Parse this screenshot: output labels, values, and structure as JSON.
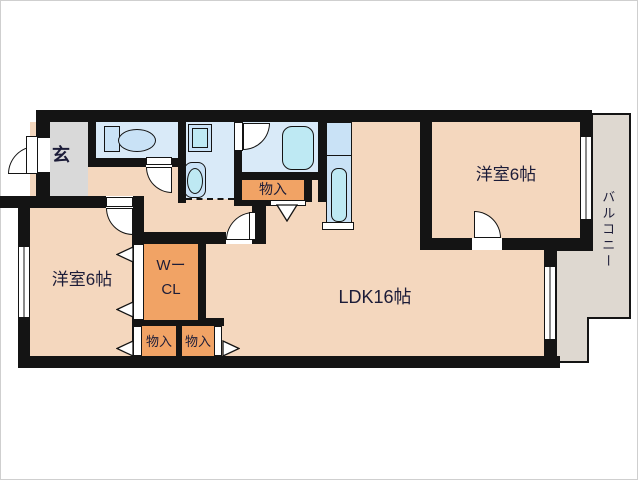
{
  "floor_plan": {
    "entrance": {
      "label": "玄"
    },
    "bedroom_left": {
      "label": "洋室6帖"
    },
    "bedroom_right": {
      "label": "洋室6帖"
    },
    "walk_in_closet": {
      "label_line1": "Wー",
      "label_line2": "CL"
    },
    "ldk": {
      "label": "LDK16帖"
    },
    "storage_top": {
      "label": "物入"
    },
    "storage_left": {
      "label": "物入"
    },
    "storage_right": {
      "label": "物入"
    },
    "balcony": {
      "label": "バルコニー"
    },
    "colors": {
      "floor": "#F4D7BE",
      "storage": "#F1A365",
      "wet_room": "#D9EAF8",
      "fixture": "#BEE9F3",
      "counter": "#C9E2F6",
      "entrance_floor": "#D9D9D9",
      "balcony_floor": "#DED8D0",
      "wall": "#141414",
      "text": "#1c1c38"
    }
  }
}
